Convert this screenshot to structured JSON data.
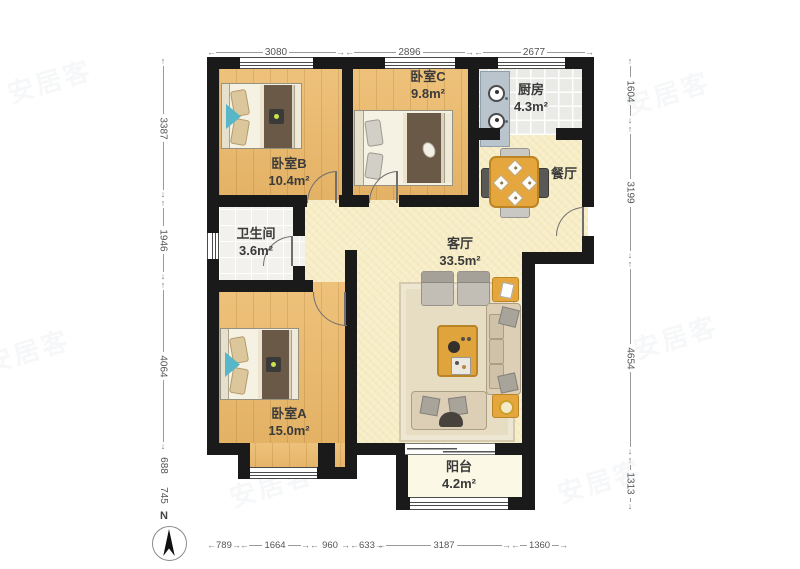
{
  "watermark": "安居客",
  "compass": {
    "label": "N"
  },
  "icons": {
    "arrow_left": "←",
    "arrow_right": "→",
    "arrow_up": "↑",
    "arrow_down": "↓",
    "bed": "bed",
    "stove": "stove",
    "dining_table": "dining-table",
    "sofa": "sofa",
    "tv": "tv"
  },
  "rooms": {
    "bedroomA": {
      "name": "卧室A",
      "area": "15.0m²"
    },
    "bedroomB": {
      "name": "卧室B",
      "area": "10.4m²"
    },
    "bedroomC": {
      "name": "卧室C",
      "area": "9.8m²"
    },
    "kitchen": {
      "name": "厨房",
      "area": "4.3m²"
    },
    "dining": {
      "name": "餐厅"
    },
    "bathroom": {
      "name": "卫生间",
      "area": "3.6m²"
    },
    "living": {
      "name": "客厅",
      "area": "33.5m²"
    },
    "balcony": {
      "name": "阳台",
      "area": "4.2m²"
    }
  },
  "dims": {
    "top": [
      "3080",
      "2896",
      "2677"
    ],
    "bottom": [
      "789",
      "1664",
      "960",
      "633",
      "3187",
      "1360"
    ],
    "left": [
      "3387",
      "1946",
      "4064",
      "688",
      "745"
    ],
    "right": [
      "1604",
      "3199",
      "4654",
      "1313"
    ]
  },
  "colors": {
    "wall": "#1a1a1a",
    "wood_floor": "#ecb969",
    "public_floor": "#f7edc7",
    "furniture_accent": "#e5a63e",
    "teal_accent": "#58b6c9"
  }
}
